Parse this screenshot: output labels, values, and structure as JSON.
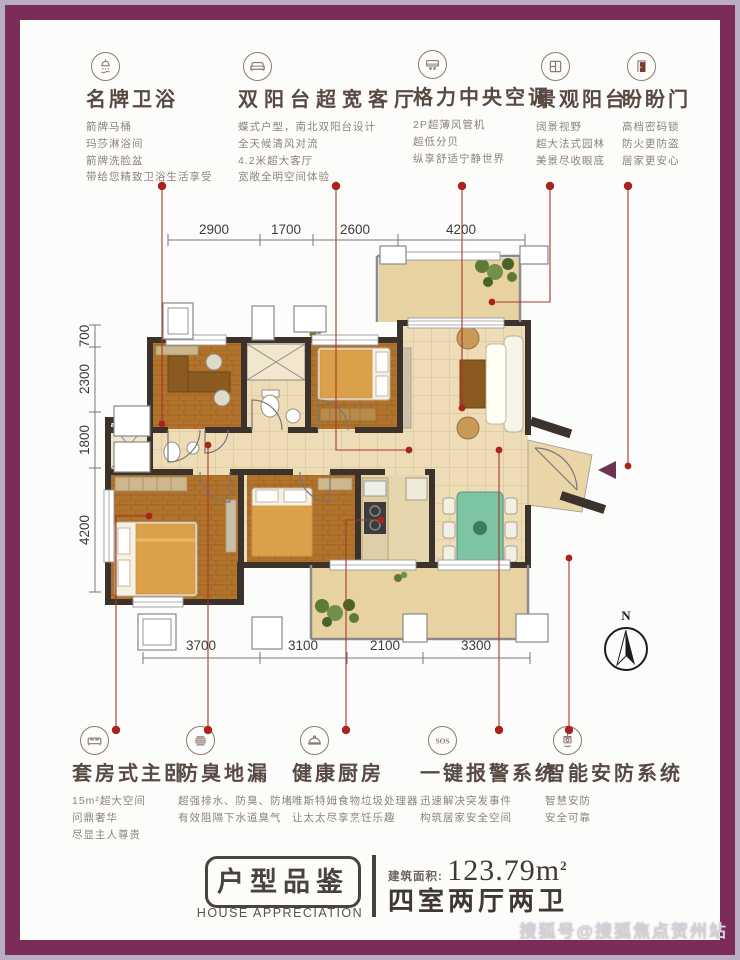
{
  "watermark": "搜狐号@搜狐焦点贺州站",
  "features_top": [
    {
      "icon": "shower-icon",
      "title": "名牌卫浴",
      "lines": [
        "箭牌马桶",
        "玛莎淋浴间",
        "箭牌洗脸盆",
        "带给您精致卫浴生活享受"
      ]
    },
    {
      "icon": "sofa-icon",
      "title": "双阳台超宽客厅",
      "lines": [
        "蝶式户型，南北双阳台设计",
        "全天候清风对流",
        "4.2米超大客厅",
        "宽敞全明空间体验"
      ]
    },
    {
      "icon": "ac-icon",
      "title": "格力中央空调",
      "lines": [
        "2P超薄风管机",
        "超低分贝",
        "纵享舒适宁静世界"
      ]
    },
    {
      "icon": "balcony-window-icon",
      "title": "景观阳台",
      "lines": [
        "阔景视野",
        "超大法式园林",
        "美景尽收眼底"
      ]
    },
    {
      "icon": "door-icon",
      "title": "盼盼门",
      "lines": [
        "高档密码锁",
        "防火更防盗",
        "居家更安心"
      ]
    }
  ],
  "features_bottom": [
    {
      "icon": "bed-icon",
      "title": "套房式主卧",
      "lines": [
        "15m²超大空间",
        "问鼎奢华",
        "尽显主人尊贵"
      ]
    },
    {
      "icon": "drain-icon",
      "title": "防臭地漏",
      "lines": [
        "超强排水、防臭、防堵",
        "有效阻隔下水道臭气"
      ]
    },
    {
      "icon": "cloche-icon",
      "title": "健康厨房",
      "lines": [
        "唯斯特姆食物垃圾处理器",
        "让太太尽享烹饪乐趣"
      ]
    },
    {
      "icon": "sos-icon",
      "title": "一键报警系统",
      "lines": [
        "迅速解决突发事件",
        "构筑居家安全空间"
      ]
    },
    {
      "icon": "camera-icon",
      "title": "智能安防系统",
      "lines": [
        "智慧安防",
        "安全可靠"
      ]
    }
  ],
  "plan": {
    "dims_top": [
      "2900",
      "1700",
      "2600",
      "4200"
    ],
    "dims_left": [
      "700",
      "2300",
      "1800",
      "4200"
    ],
    "dims_bottom": [
      "3700",
      "3100",
      "2100",
      "3300"
    ],
    "compass_label": "N"
  },
  "footer": {
    "badge": "户型品鉴",
    "badge_en": "HOUSE APPRECIATION",
    "area_label": "建筑面积:",
    "area_value": "123.79m",
    "area_sup": "2",
    "layout": "四室两厅两卫"
  },
  "colors": {
    "frame": "#7b2d57",
    "accent_red": "#a8241c"
  }
}
